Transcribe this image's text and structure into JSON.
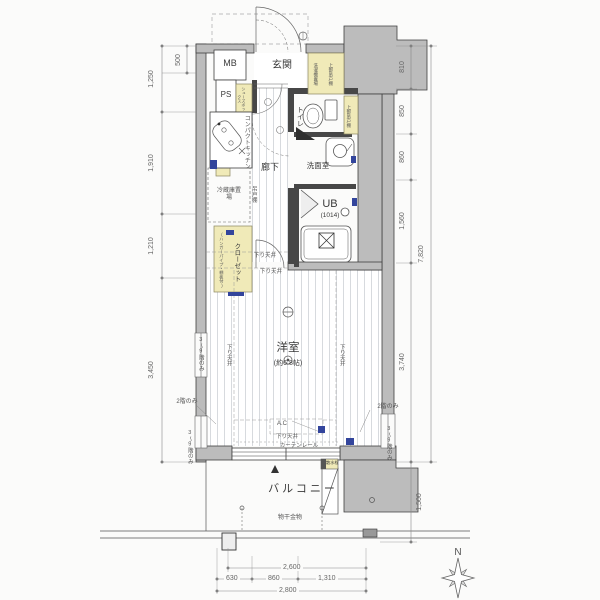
{
  "plan": {
    "rooms": {
      "entrance": "玄関",
      "hallway": "廊下",
      "toilet": "トイレ",
      "washroom": "洗面室",
      "unit_bath": "UB",
      "unit_bath_size": "(1014)",
      "main_room": "洋室",
      "main_room_size": "(約6.8帖)",
      "balcony": "バルコニー"
    },
    "equipment": {
      "meter_box": "MB",
      "pipe_space": "PS",
      "shoe_box": "シューズボックス",
      "compact_kitchen": "コンパクトキッチン",
      "hanging_cupboard": "吊戸棚",
      "fridge_space": "冷蔵庫置場",
      "closet": "クローゼット",
      "closet_note": "(ハンガーパイプ・棚板付)",
      "laundry_space": "洗濯機置場",
      "upper_cabinet": "上部吊戸棚",
      "air_con": "A.C",
      "curtain_rail": "カーテンレール",
      "lowered_ceiling": "下り天井",
      "laundry_pole": "物干金物",
      "water_tap": "散水栓"
    },
    "notes": {
      "second_floor_only": "2階のみ",
      "third_to_ninth_only": "3〜9階のみ"
    },
    "dimensions": {
      "left": [
        "500",
        "1,250",
        "1,910",
        "1,210",
        "3,450"
      ],
      "right": [
        "810",
        "850",
        "860",
        "1,560",
        "3,740",
        "7,820",
        "1,500"
      ],
      "bottom": [
        "2,600",
        "630",
        "860",
        "1,310",
        "2,800"
      ]
    },
    "compass": {
      "north": "N"
    }
  }
}
